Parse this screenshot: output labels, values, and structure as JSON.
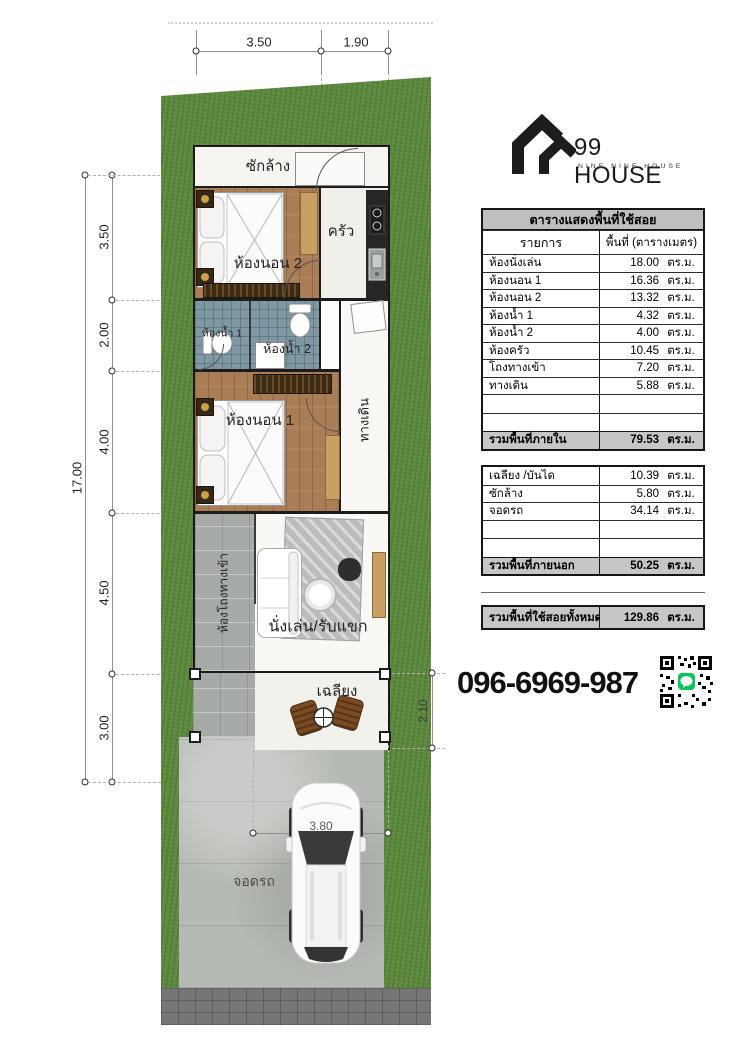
{
  "logo": {
    "brand": "99 HOUSE",
    "tagline": "NINE NINE HOUSE"
  },
  "contact": {
    "phone": "096-6969-987"
  },
  "area_table": {
    "title": "ตารางแสดงพื้นที่ใช้สอย",
    "columns": {
      "item": "รายการ",
      "area": "พื้นที่ (ตารางเมตร)"
    },
    "unit": "ตร.ม.",
    "interior": {
      "rows": [
        {
          "label": "ห้องนั่งเล่น",
          "value": "18.00"
        },
        {
          "label": "ห้องนอน 1",
          "value": "16.36"
        },
        {
          "label": "ห้องนอน 2",
          "value": "13.32"
        },
        {
          "label": "ห้องน้ำ 1",
          "value": "4.32"
        },
        {
          "label": "ห้องน้ำ 2",
          "value": "4.00"
        },
        {
          "label": "ห้องครัว",
          "value": "10.45"
        },
        {
          "label": "โถงทางเข้า",
          "value": "7.20"
        },
        {
          "label": "ทางเดิน",
          "value": "5.88"
        }
      ],
      "total_label": "รวมพื้นที่ภายใน",
      "total_value": "79.53"
    },
    "exterior": {
      "rows": [
        {
          "label": "เฉลียง /บันได",
          "value": "10.39"
        },
        {
          "label": "ซักล้าง",
          "value": "5.80"
        },
        {
          "label": "จอดรถ",
          "value": "34.14"
        }
      ],
      "total_label": "รวมพื้นที่ภายนอก",
      "total_value": "50.25"
    },
    "grand_total": {
      "label": "รวมพื้นที่ใช้สอยทั้งหมด",
      "value": "129.86"
    }
  },
  "plan": {
    "rooms": {
      "laundry": "ซักล้าง",
      "bedroom2": "ห้องนอน 2",
      "kitchen": "ครัว",
      "bath1": "ห้องน้ำ 1",
      "bath2": "ห้องน้ำ 2",
      "bedroom1": "ห้องนอน 1",
      "hallway": "ทางเดิน",
      "entry_hall": "ห้องโถงทางเข้า",
      "living": "นั่งเล่น/รับแขก",
      "porch": "เฉลียง",
      "carport": "จอดรถ"
    },
    "dimensions": {
      "top": [
        "3.50",
        "1.90"
      ],
      "left": [
        "3.50",
        "2.00",
        "4.00",
        "4.50",
        "3.00"
      ],
      "left_total": "17.00",
      "porch_depth": "2.10",
      "carport_width": "3.80"
    }
  },
  "colors": {
    "grass": "#5d8a3e",
    "road": "#767676",
    "concrete": "#b6bab4",
    "wood_floor": "#a97d55",
    "bath_tile": "#7e98a4",
    "counter_dark": "#262626",
    "stone_path": "#a7aba7",
    "line_green": "#06c755"
  }
}
